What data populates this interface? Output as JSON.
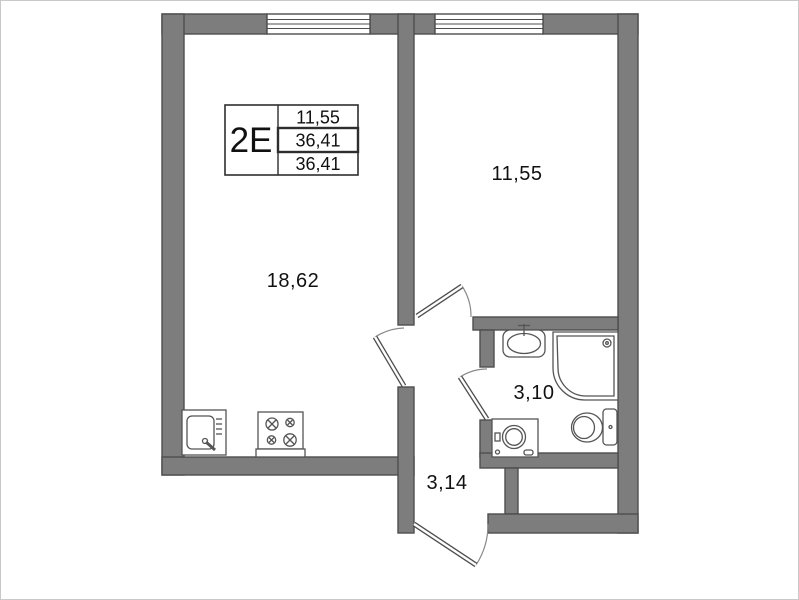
{
  "plan": {
    "unit": {
      "type_label": "2E"
    },
    "info_table": {
      "rows": [
        "11,55",
        "36,41",
        "36,41"
      ]
    },
    "rooms": {
      "living_kitchen": {
        "area": "18,62"
      },
      "bedroom": {
        "area": "11,55"
      },
      "bathroom": {
        "area": "3,10"
      },
      "hallway": {
        "area": "3,14"
      }
    },
    "colors": {
      "wall_fill": "#7d7d7d",
      "wall_outline": "#4e4e4e",
      "fixture_stroke": "#555555",
      "text": "#111111",
      "frame": "#c9c9c9"
    }
  }
}
